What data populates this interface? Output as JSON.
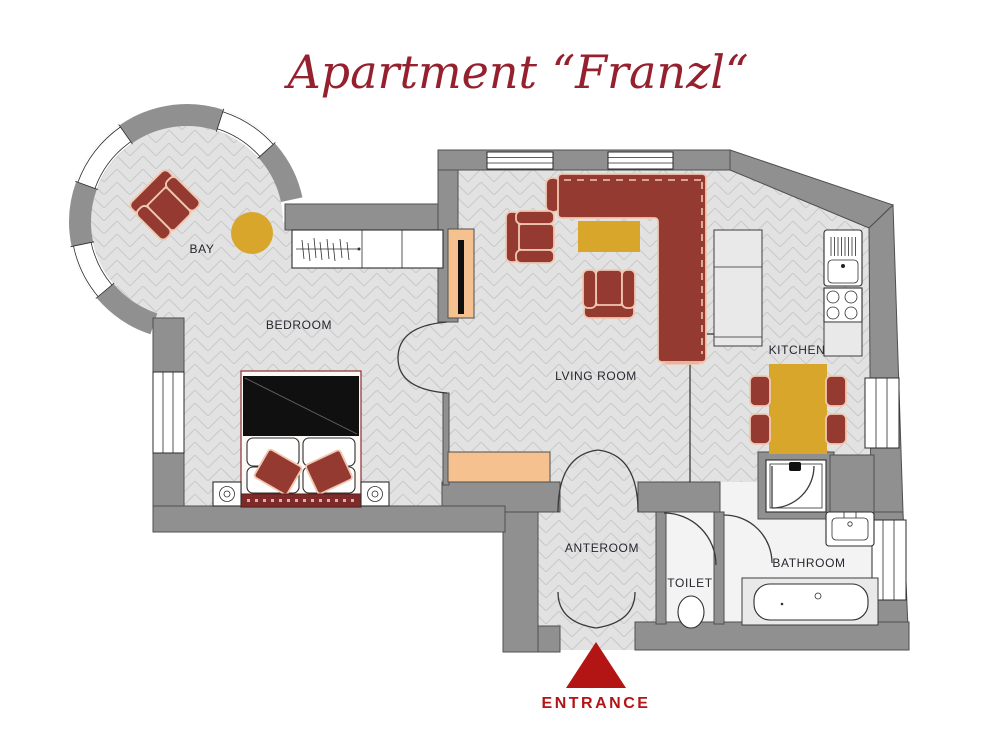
{
  "title": "Apartment “Franzl“",
  "rooms": {
    "bay": "BAY",
    "bedroom": "BEDROOM",
    "living_room": "LVING ROOM",
    "kitchen": "KITCHEN",
    "anteroom": "ANTEROOM",
    "toilet": "TOILET",
    "bathroom": "BATHROOM"
  },
  "entrance_label": "ENTRANCE",
  "colors": {
    "title_red": "#96212e",
    "entrance_red": "#b31414",
    "wall_gray": "#909090",
    "floor_light": "#e2e2e2",
    "floor_line": "#c9c9c9",
    "bath_floor": "#f3f3f3",
    "furniture_red": "#953a31",
    "furniture_trim": "#f0c7b1",
    "accent_gold": "#d8a62a",
    "stove_peach": "#f5c18e"
  }
}
